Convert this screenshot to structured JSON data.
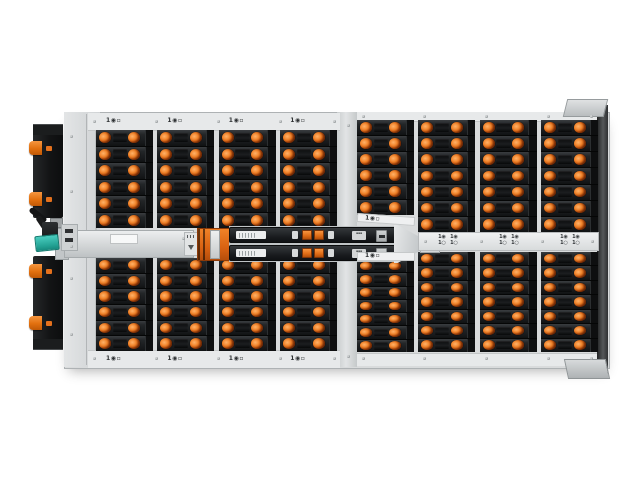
{
  "colors": {
    "latch_orange": "#e4711d",
    "teal_connector": "#2fb9ab",
    "chassis_gray": "#d9dbdc",
    "bay_black": "#17191b",
    "module_black": "#1d2022"
  },
  "legend": {
    "bay_zone_label": "1◉▫",
    "indicator_top": "1◉",
    "indicator_bottom": "1○"
  },
  "header_left_labels": [
    "1◉▫",
    "1◉▫",
    "1◉▫",
    "1◉▫"
  ],
  "footer_left_labels": [
    "1◉▫",
    "1◉▫",
    "1◉▫",
    "1◉▫"
  ],
  "zone_labels": {
    "top": "1◉▫",
    "bottom": "1◉▫"
  },
  "indicator_rail": {
    "pair_count": 3,
    "units_per_pair": 2
  },
  "quadrants": {
    "top_left": {
      "columns": 4,
      "rows_per_column": [
        6,
        6,
        6,
        6
      ]
    },
    "top_right": {
      "columns": 4,
      "rows_per_column": [
        6,
        7,
        7,
        7
      ]
    },
    "bottom_left": {
      "columns": 4,
      "rows_per_column": [
        6,
        6,
        6,
        6
      ]
    },
    "bottom_right": {
      "columns": 4,
      "rows_per_column": [
        7,
        7,
        7,
        7
      ]
    }
  },
  "io_modules": {
    "count": 2,
    "latches_per_module": 2
  },
  "total_drive_bays": 103
}
